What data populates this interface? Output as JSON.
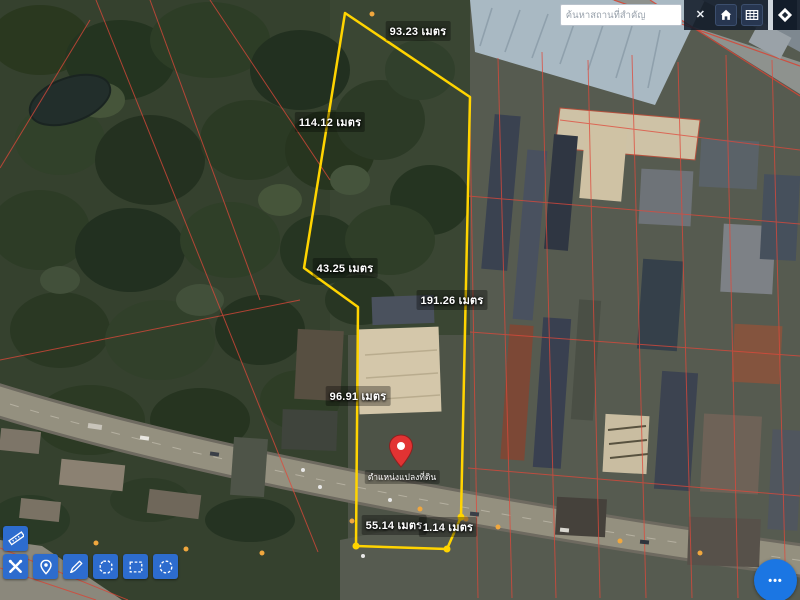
{
  "topbar": {
    "search": {
      "placeholder": "ค้นหาสถานที่สำคัญ",
      "value": ""
    },
    "close_label": "✕"
  },
  "measurements": {
    "unit": "เมตร",
    "items": [
      {
        "id": "top-edge",
        "text": "93.23 เมตร",
        "value": 93.23
      },
      {
        "id": "left-edge",
        "text": "114.12 เมตร",
        "value": 114.12
      },
      {
        "id": "left-lower",
        "text": "43.25 เมตร",
        "value": 43.25
      },
      {
        "id": "right-edge",
        "text": "191.26 เมตร",
        "value": 191.26
      },
      {
        "id": "stem-left",
        "text": "96.91 เมตร",
        "value": 96.91
      },
      {
        "id": "bottom-edge",
        "text": "55.14 เมตร",
        "value": 55.14
      },
      {
        "id": "bottom-corner",
        "text": "1.14 เมตร",
        "value": 1.14
      }
    ]
  },
  "pin": {
    "label": "ตำแหน่งแปลงที่ดิน"
  },
  "fab": {
    "label": "•••"
  },
  "toolbar": {
    "tools": [
      {
        "name": "measure-ruler"
      },
      {
        "name": "tools"
      },
      {
        "name": "drop-pin"
      },
      {
        "name": "draw-line"
      },
      {
        "name": "draw-polygon"
      },
      {
        "name": "draw-rectangle"
      },
      {
        "name": "draw-circle"
      }
    ]
  },
  "colors": {
    "parcel_outline": "#ffd400",
    "pin": "#e23333",
    "toolbar_button": "#2d6cce",
    "fab": "#1b76e3",
    "cadastral_line": "#e0483a"
  }
}
